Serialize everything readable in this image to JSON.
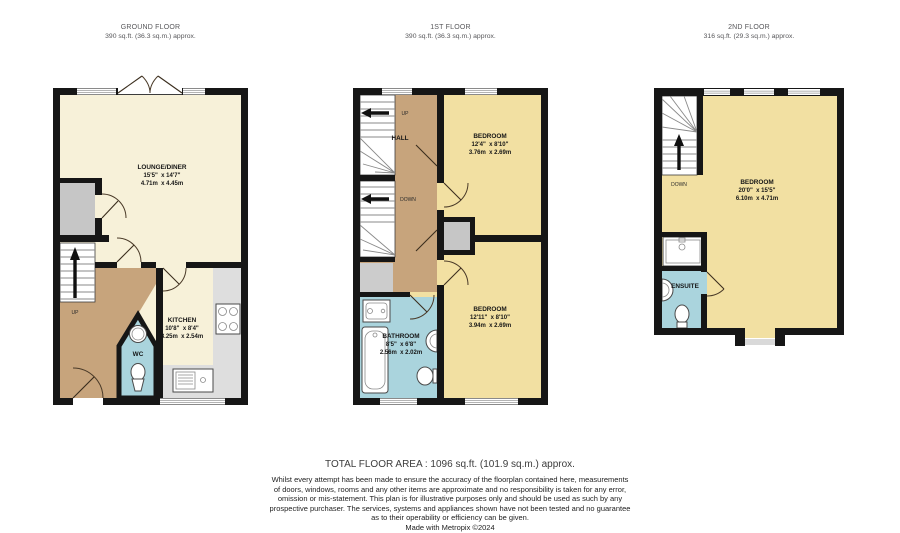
{
  "colors": {
    "wall": "#161616",
    "lounge_cream": "#f7f1d9",
    "bedroom_gold": "#f2e0a2",
    "hall_tan": "#c7a47c",
    "bathroom_blue": "#aad4dd",
    "cupboard_grey": "#c6c6c6",
    "counter_grey": "#dedede"
  },
  "floors": {
    "ground": {
      "title": "GROUND FLOOR",
      "area": "390 sq.ft. (36.3 sq.m.) approx.",
      "lounge": {
        "name": "LOUNGE/DINER",
        "ft": "15'5\"  x 14'7\"",
        "m": "4.71m  x 4.45m"
      },
      "kitchen": {
        "name": "KITCHEN",
        "ft": "10'8\"  x 8'4\"",
        "m": "3.25m  x 2.54m"
      },
      "wc_label": "WC",
      "up_label": "UP",
      "fixtures": [
        "stairs",
        "storage-cupboard",
        "wc-sink",
        "wc-toilet",
        "hob",
        "kitchen-sink",
        "french-doors",
        "windows"
      ]
    },
    "first": {
      "title": "1ST FLOOR",
      "area": "390 sq.ft. (36.3 sq.m.) approx.",
      "hall_label": "HALL",
      "up_label": "UP",
      "down_label": "DOWN",
      "bedroom1": {
        "name": "BEDROOM",
        "ft": "12'4\"  x 8'10\"",
        "m": "3.76m  x 2.69m"
      },
      "bedroom2": {
        "name": "BEDROOM",
        "ft": "12'11\"  x 8'10\"",
        "m": "3.94m  x 2.69m"
      },
      "bathroom": {
        "name": "BATHROOM",
        "ft": "8'5\"  x 6'8\"",
        "m": "2.56m  x 2.02m"
      },
      "fixtures": [
        "stairs-up",
        "stairs-down",
        "closet",
        "bath",
        "vanity-basin",
        "pedestal-sink",
        "toilet",
        "windows"
      ]
    },
    "second": {
      "title": "2ND FLOOR",
      "area": "316 sq.ft. (29.3 sq.m.) approx.",
      "down_label": "DOWN",
      "bedroom": {
        "name": "BEDROOM",
        "ft": "20'0\"  x 15'5\"",
        "m": "6.10m  x 4.71m"
      },
      "ensuite_label": "ENSUITE",
      "fixtures": [
        "stairs-down",
        "shower",
        "basin",
        "toilet",
        "dormer-window",
        "windows"
      ]
    }
  },
  "footer": {
    "total": "TOTAL FLOOR AREA : 1096 sq.ft. (101.9 sq.m.) approx.",
    "disclaimer": [
      "Whilst every attempt has been made to ensure the accuracy of the floorplan contained here, measurements",
      "of doors, windows, rooms and any other items are approximate and no responsibility is taken for any error,",
      "omission or mis-statement. This plan is for illustrative purposes only and should be used as such by any",
      "prospective purchaser. The services, systems and appliances shown have not been tested and no guarantee",
      "as to their operability or efficiency can be given."
    ],
    "credit": "Made with Metropix ©2024"
  }
}
